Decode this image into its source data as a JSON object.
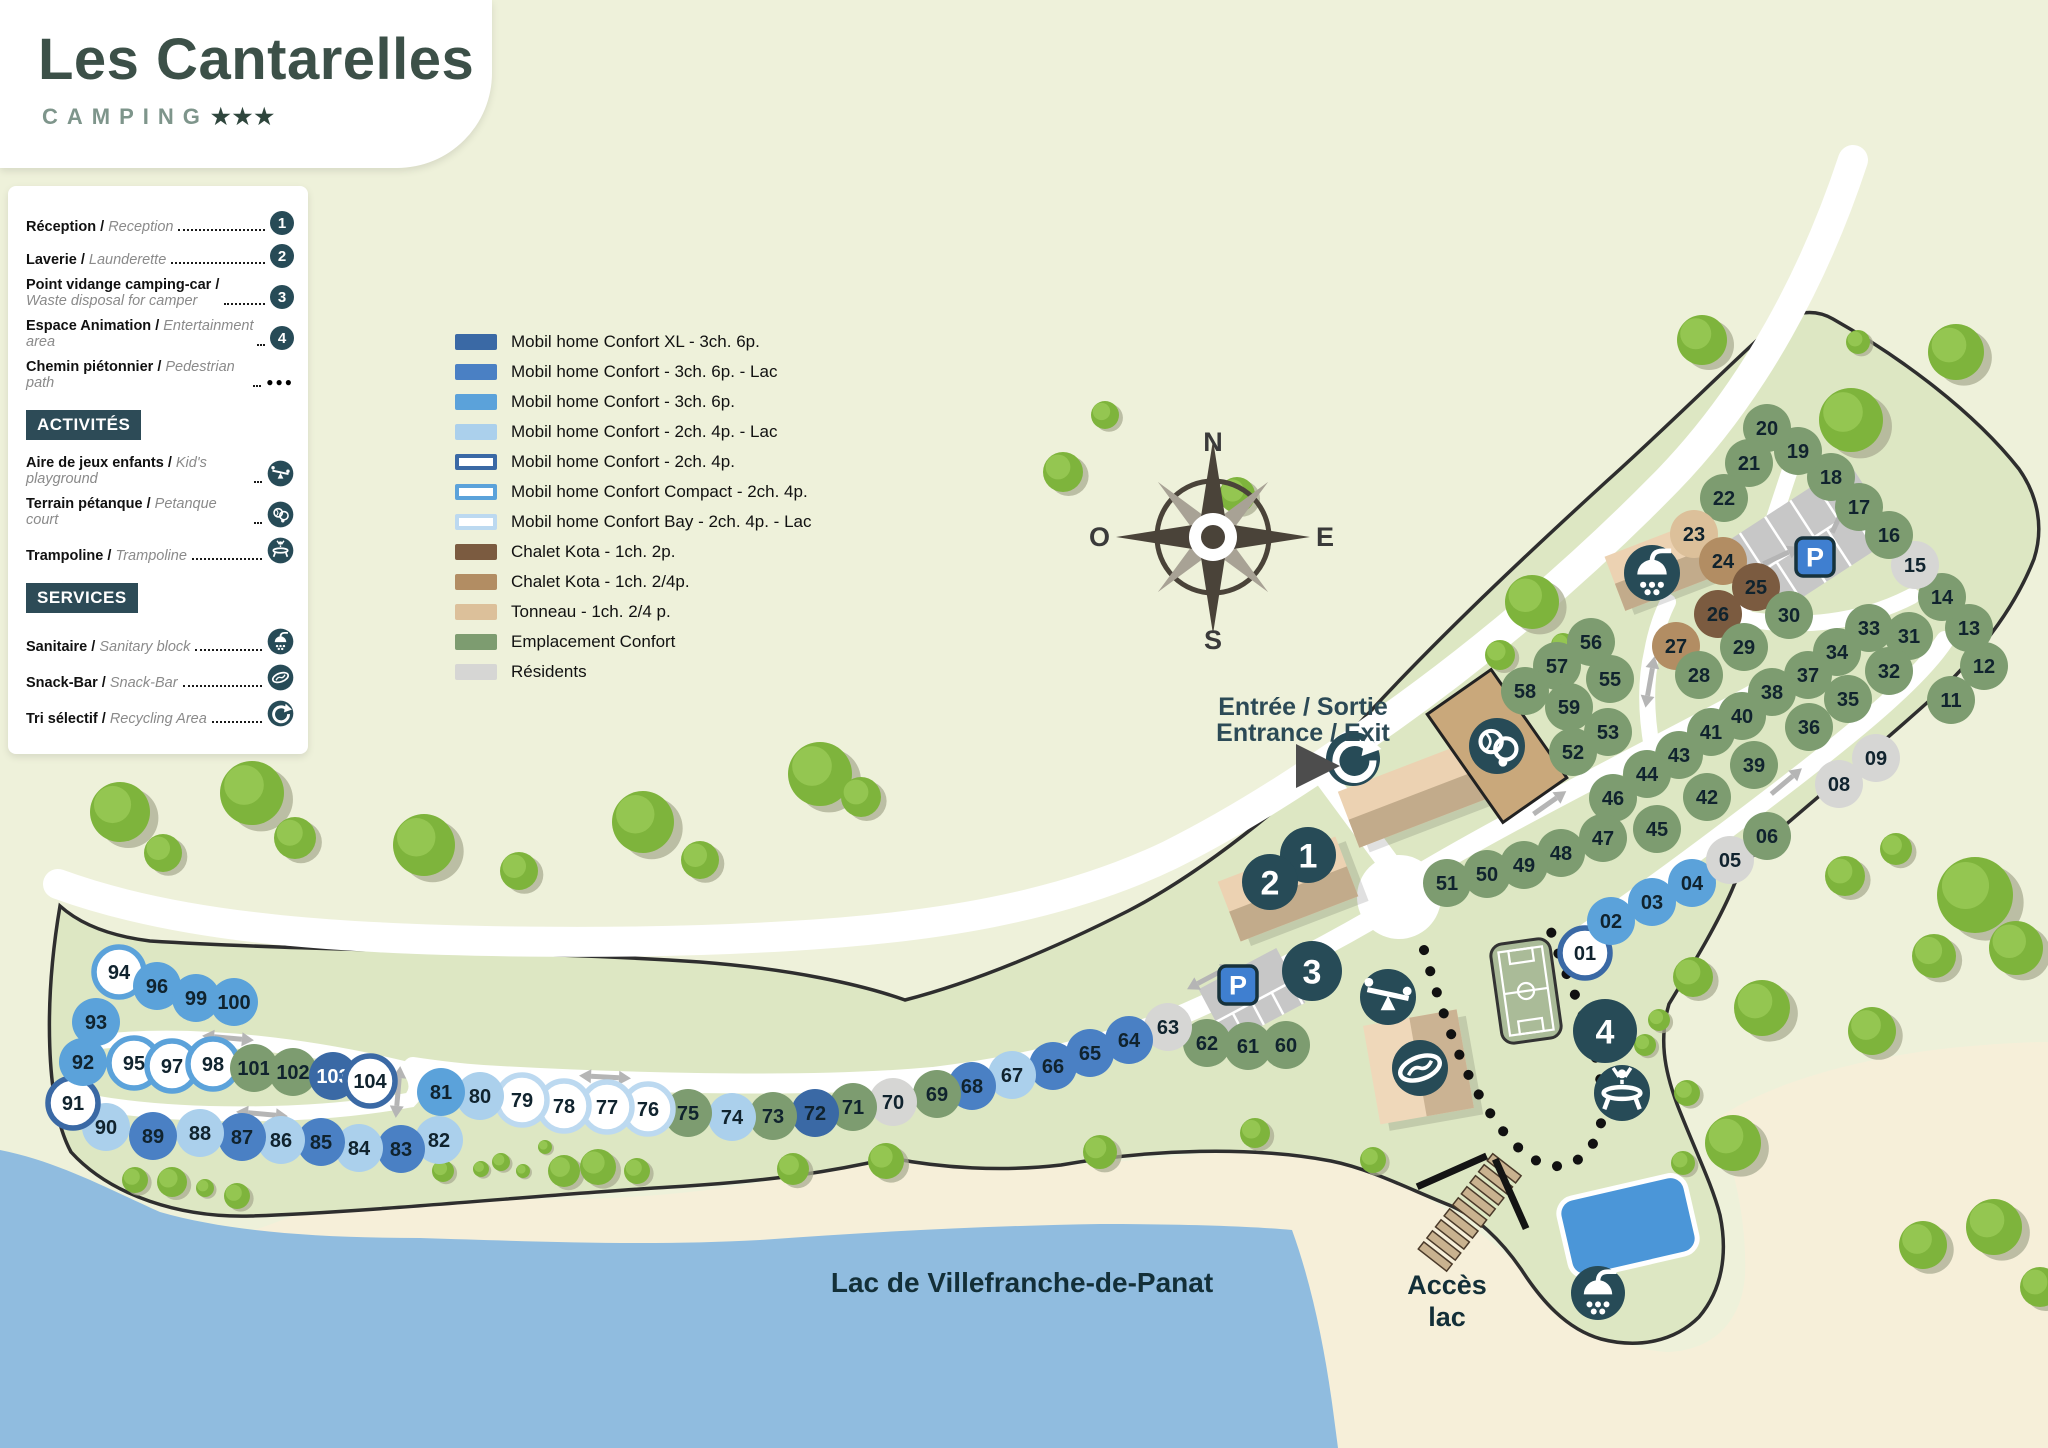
{
  "logo": {
    "title": "Les Cantarelles",
    "subtitle": "CAMPING",
    "stars": "★★★"
  },
  "legend": {
    "facilities": [
      {
        "fr": "Réception / ",
        "en": "Reception",
        "badge": "1",
        "two_line": false
      },
      {
        "fr": "Laverie / ",
        "en": "Launderette ",
        "badge": "2",
        "two_line": false
      },
      {
        "fr": "Point vidange camping-car /",
        "en": "Waste disposal for camper",
        "badge": "3",
        "two_line": true
      },
      {
        "fr": "Espace Animation / ",
        "en": "Entertainment area ",
        "badge": "4",
        "two_line": false
      },
      {
        "fr": "Chemin piétonnier / ",
        "en": "Pedestrian path",
        "badge": "dots",
        "two_line": false
      }
    ],
    "activities_title": "ACTIVITÉS",
    "activities": [
      {
        "fr": "Aire de jeux enfants  / ",
        "en": "Kid's playground",
        "icon": "playground"
      },
      {
        "fr": "Terrain pétanque / ",
        "en": "Petanque court ",
        "icon": "petanque"
      },
      {
        "fr": "Trampoline / ",
        "en": "Trampoline",
        "icon": "trampoline"
      }
    ],
    "services_title": "SERVICES",
    "services": [
      {
        "fr": "Sanitaire / ",
        "en": "Sanitary block",
        "icon": "shower"
      },
      {
        "fr": "Snack-Bar / ",
        "en": "Snack-Bar ",
        "icon": "snackbar"
      },
      {
        "fr": "Tri sélectif / ",
        "en": "Recycling Area ",
        "icon": "recycle"
      }
    ]
  },
  "accommodation_legend": [
    {
      "type": "xl",
      "label": "Mobil home Confort XL - 3ch. 6p."
    },
    {
      "type": "lac6",
      "label": "Mobil home Confort - 3ch. 6p. - Lac"
    },
    {
      "type": "c6",
      "label": "Mobil home Confort - 3ch. 6p."
    },
    {
      "type": "lac4",
      "label": "Mobil home Confort - 2ch. 4p. - Lac"
    },
    {
      "type": "c4",
      "label": "Mobil home Confort - 2ch. 4p."
    },
    {
      "type": "compact",
      "label": "Mobil home Confort Compact - 2ch. 4p."
    },
    {
      "type": "bay",
      "label": "Mobil home Confort Bay - 2ch. 4p. - Lac"
    },
    {
      "type": "kota2",
      "label": "Chalet Kota - 1ch. 2p."
    },
    {
      "type": "kota24",
      "label": "Chalet Kota - 1ch. 2/4p."
    },
    {
      "type": "tonneau",
      "label": "Tonneau - 1ch. 2/4 p."
    },
    {
      "type": "conf",
      "label": "Emplacement Confort"
    },
    {
      "type": "res",
      "label": "Résidents"
    }
  ],
  "site_types": {
    "xl": {
      "fill": "#3a69a5",
      "stroke": null,
      "r": 24
    },
    "lac6": {
      "fill": "#4a80c4",
      "stroke": null,
      "r": 24
    },
    "c6": {
      "fill": "#5ba2da",
      "stroke": null,
      "r": 24
    },
    "lac4": {
      "fill": "#abd0ec",
      "stroke": null,
      "r": 24
    },
    "c4": {
      "fill": "#ffffff",
      "stroke": "#3a69a5",
      "r": 25
    },
    "compact": {
      "fill": "#ffffff",
      "stroke": "#5ba2da",
      "r": 25
    },
    "bay": {
      "fill": "#ffffff",
      "stroke": "#bcd9f0",
      "r": 25
    },
    "kota2": {
      "fill": "#7b5b40",
      "stroke": null,
      "r": 24
    },
    "kota24": {
      "fill": "#b28d63",
      "stroke": null,
      "r": 24
    },
    "tonneau": {
      "fill": "#dcc09a",
      "stroke": null,
      "r": 24
    },
    "conf": {
      "fill": "#7d9c70",
      "stroke": null,
      "r": 24
    },
    "res": {
      "fill": "#d6d6d4",
      "stroke": null,
      "r": 24
    }
  },
  "compass": {
    "n": "N",
    "e": "E",
    "s": "S",
    "o": "O"
  },
  "labels": {
    "entrance_line1": "Entrée / Sortie",
    "entrance_line2": "Entrance / Exit",
    "lake": "Lac de Villefranche-de-Panat",
    "lake_access_line1": "Accès",
    "lake_access_line2": "lac",
    "parking": "P"
  },
  "map": {
    "markers": [
      [
        "1",
        1308,
        855,
        28
      ],
      [
        "2",
        1270,
        882,
        28
      ],
      [
        "3",
        1312,
        971,
        30
      ],
      [
        "4",
        1605,
        1031,
        32
      ]
    ],
    "icons": [
      [
        "recycle",
        1353,
        759,
        27
      ],
      [
        "petanque",
        1497,
        746,
        28
      ],
      [
        "shower",
        1652,
        573,
        28
      ],
      [
        "playground",
        1388,
        997,
        28
      ],
      [
        "snackbar",
        1420,
        1068,
        28
      ],
      [
        "trampoline",
        1622,
        1093,
        28
      ],
      [
        "shower",
        1598,
        1293,
        27
      ]
    ],
    "p_signs": [
      [
        1238,
        985
      ],
      [
        1815,
        557
      ]
    ],
    "sites": [
      [
        "01",
        1585,
        953,
        "c4"
      ],
      [
        "02",
        1611,
        921,
        "c6"
      ],
      [
        "03",
        1652,
        902,
        "c6"
      ],
      [
        "04",
        1692,
        883,
        "c6"
      ],
      [
        "05",
        1730,
        860,
        "res"
      ],
      [
        "06",
        1767,
        836,
        "conf"
      ],
      [
        "08",
        1839,
        784,
        "res"
      ],
      [
        "09",
        1876,
        758,
        "res"
      ],
      [
        "11",
        1951,
        700,
        "conf"
      ],
      [
        "12",
        1984,
        666,
        "conf"
      ],
      [
        "13",
        1969,
        628,
        "conf"
      ],
      [
        "14",
        1942,
        597,
        "conf"
      ],
      [
        "15",
        1915,
        565,
        "res"
      ],
      [
        "16",
        1889,
        535,
        "conf"
      ],
      [
        "17",
        1859,
        507,
        "conf"
      ],
      [
        "18",
        1831,
        477,
        "conf"
      ],
      [
        "19",
        1798,
        451,
        "conf"
      ],
      [
        "20",
        1767,
        428,
        "conf"
      ],
      [
        "21",
        1749,
        463,
        "conf"
      ],
      [
        "22",
        1724,
        498,
        "conf"
      ],
      [
        "23",
        1694,
        534,
        "tonneau"
      ],
      [
        "24",
        1723,
        561,
        "kota24"
      ],
      [
        "25",
        1756,
        587,
        "kota2"
      ],
      [
        "26",
        1718,
        614,
        "kota2"
      ],
      [
        "27",
        1676,
        646,
        "kota24"
      ],
      [
        "28",
        1699,
        675,
        "conf"
      ],
      [
        "29",
        1744,
        647,
        "conf"
      ],
      [
        "30",
        1789,
        615,
        "conf"
      ],
      [
        "31",
        1909,
        636,
        "conf"
      ],
      [
        "32",
        1889,
        671,
        "conf"
      ],
      [
        "33",
        1869,
        628,
        "conf"
      ],
      [
        "34",
        1837,
        652,
        "conf"
      ],
      [
        "35",
        1848,
        699,
        "conf"
      ],
      [
        "36",
        1809,
        727,
        "conf"
      ],
      [
        "37",
        1808,
        675,
        "conf"
      ],
      [
        "38",
        1772,
        692,
        "conf"
      ],
      [
        "39",
        1754,
        765,
        "conf"
      ],
      [
        "40",
        1742,
        716,
        "conf"
      ],
      [
        "41",
        1711,
        732,
        "conf"
      ],
      [
        "42",
        1707,
        797,
        "conf"
      ],
      [
        "43",
        1679,
        755,
        "conf"
      ],
      [
        "44",
        1647,
        774,
        "conf"
      ],
      [
        "45",
        1657,
        829,
        "conf"
      ],
      [
        "46",
        1613,
        798,
        "conf"
      ],
      [
        "47",
        1603,
        838,
        "conf"
      ],
      [
        "48",
        1561,
        853,
        "conf"
      ],
      [
        "49",
        1524,
        865,
        "conf"
      ],
      [
        "50",
        1487,
        874,
        "conf"
      ],
      [
        "51",
        1447,
        883,
        "conf"
      ],
      [
        "52",
        1573,
        752,
        "conf"
      ],
      [
        "53",
        1608,
        732,
        "conf"
      ],
      [
        "55",
        1610,
        679,
        "conf"
      ],
      [
        "56",
        1591,
        642,
        "conf"
      ],
      [
        "57",
        1557,
        666,
        "conf"
      ],
      [
        "58",
        1525,
        691,
        "conf"
      ],
      [
        "59",
        1569,
        707,
        "conf"
      ],
      [
        "60",
        1286,
        1045,
        "conf"
      ],
      [
        "61",
        1248,
        1046,
        "conf"
      ],
      [
        "62",
        1207,
        1043,
        "conf"
      ],
      [
        "63",
        1168,
        1027,
        "res"
      ],
      [
        "64",
        1129,
        1040,
        "lac6"
      ],
      [
        "65",
        1090,
        1053,
        "lac6"
      ],
      [
        "66",
        1053,
        1066,
        "lac6"
      ],
      [
        "67",
        1012,
        1075,
        "lac4"
      ],
      [
        "68",
        972,
        1086,
        "lac6"
      ],
      [
        "69",
        937,
        1094,
        "conf"
      ],
      [
        "70",
        893,
        1102,
        "res"
      ],
      [
        "71",
        853,
        1107,
        "conf"
      ],
      [
        "72",
        815,
        1113,
        "xl"
      ],
      [
        "73",
        773,
        1116,
        "conf"
      ],
      [
        "74",
        732,
        1117,
        "lac4"
      ],
      [
        "75",
        688,
        1113,
        "conf"
      ],
      [
        "76",
        648,
        1109,
        "bay"
      ],
      [
        "77",
        607,
        1107,
        "bay"
      ],
      [
        "78",
        564,
        1106,
        "bay"
      ],
      [
        "79",
        522,
        1100,
        "bay"
      ],
      [
        "80",
        480,
        1096,
        "lac4"
      ],
      [
        "81",
        441,
        1092,
        "c6"
      ],
      [
        "82",
        439,
        1140,
        "lac4"
      ],
      [
        "83",
        401,
        1149,
        "lac6"
      ],
      [
        "84",
        359,
        1148,
        "lac4"
      ],
      [
        "85",
        321,
        1142,
        "lac6"
      ],
      [
        "86",
        281,
        1140,
        "lac4"
      ],
      [
        "87",
        242,
        1137,
        "lac6"
      ],
      [
        "88",
        200,
        1133,
        "lac4"
      ],
      [
        "89",
        153,
        1136,
        "lac6"
      ],
      [
        "90",
        106,
        1127,
        "lac4"
      ],
      [
        "91",
        73,
        1103,
        "c4"
      ],
      [
        "92",
        83,
        1062,
        "c6"
      ],
      [
        "93",
        96,
        1022,
        "c6"
      ],
      [
        "94",
        119,
        972,
        "compact"
      ],
      [
        "95",
        134,
        1063,
        "compact"
      ],
      [
        "96",
        157,
        986,
        "c6"
      ],
      [
        "97",
        172,
        1066,
        "compact"
      ],
      [
        "98",
        213,
        1064,
        "compact"
      ],
      [
        "99",
        196,
        998,
        "c6"
      ],
      [
        "100",
        234,
        1002,
        "c6"
      ],
      [
        "101",
        254,
        1068,
        "conf"
      ],
      [
        "102",
        293,
        1072,
        "conf"
      ],
      [
        "103",
        333,
        1076,
        "xl",
        "w"
      ],
      [
        "104",
        370,
        1081,
        "c4"
      ]
    ],
    "trees": [
      [
        120,
        812,
        30
      ],
      [
        163,
        853,
        19
      ],
      [
        252,
        793,
        32
      ],
      [
        295,
        838,
        21
      ],
      [
        424,
        845,
        31
      ],
      [
        519,
        871,
        19
      ],
      [
        643,
        822,
        31
      ],
      [
        700,
        860,
        19
      ],
      [
        820,
        774,
        32
      ],
      [
        861,
        797,
        20
      ],
      [
        1063,
        472,
        20
      ],
      [
        1105,
        415,
        14
      ],
      [
        1237,
        495,
        18
      ],
      [
        1532,
        602,
        27
      ],
      [
        1500,
        655,
        15
      ],
      [
        1563,
        645,
        12
      ],
      [
        1702,
        340,
        25
      ],
      [
        1858,
        342,
        12
      ],
      [
        1956,
        352,
        28
      ],
      [
        1851,
        420,
        32
      ],
      [
        1845,
        876,
        20
      ],
      [
        1896,
        849,
        16
      ],
      [
        1975,
        895,
        38
      ],
      [
        2016,
        948,
        27
      ],
      [
        1934,
        956,
        22
      ],
      [
        1693,
        977,
        20
      ],
      [
        1762,
        1008,
        28
      ],
      [
        1872,
        1031,
        24
      ],
      [
        1659,
        1020,
        11
      ],
      [
        1645,
        1045,
        11
      ],
      [
        1687,
        1093,
        13
      ],
      [
        1733,
        1143,
        28
      ],
      [
        1683,
        1163,
        12
      ],
      [
        1923,
        1245,
        24
      ],
      [
        1994,
        1227,
        28
      ],
      [
        2040,
        1287,
        20
      ],
      [
        135,
        1180,
        13
      ],
      [
        172,
        1182,
        15
      ],
      [
        205,
        1188,
        9
      ],
      [
        237,
        1196,
        13
      ],
      [
        443,
        1171,
        11
      ],
      [
        481,
        1169,
        8
      ],
      [
        501,
        1162,
        9
      ],
      [
        523,
        1171,
        7
      ],
      [
        545,
        1147,
        7
      ],
      [
        564,
        1171,
        16
      ],
      [
        598,
        1167,
        18
      ],
      [
        637,
        1171,
        13
      ],
      [
        793,
        1169,
        16
      ],
      [
        886,
        1161,
        18
      ],
      [
        1100,
        1152,
        17
      ],
      [
        1255,
        1133,
        15
      ],
      [
        1373,
        1160,
        13
      ]
    ],
    "arrows": [
      [
        605,
        1077,
        3,
        1
      ],
      [
        228,
        1038,
        5,
        1
      ],
      [
        262,
        1114,
        5,
        1
      ],
      [
        398,
        1092,
        95,
        1
      ],
      [
        1210,
        977,
        -28,
        1
      ],
      [
        1545,
        806,
        -35,
        0
      ],
      [
        1782,
        785,
        -40,
        0
      ],
      [
        1650,
        682,
        100,
        1
      ],
      [
        1838,
        520,
        -65,
        0
      ],
      [
        1776,
        558,
        -25,
        0
      ]
    ]
  }
}
